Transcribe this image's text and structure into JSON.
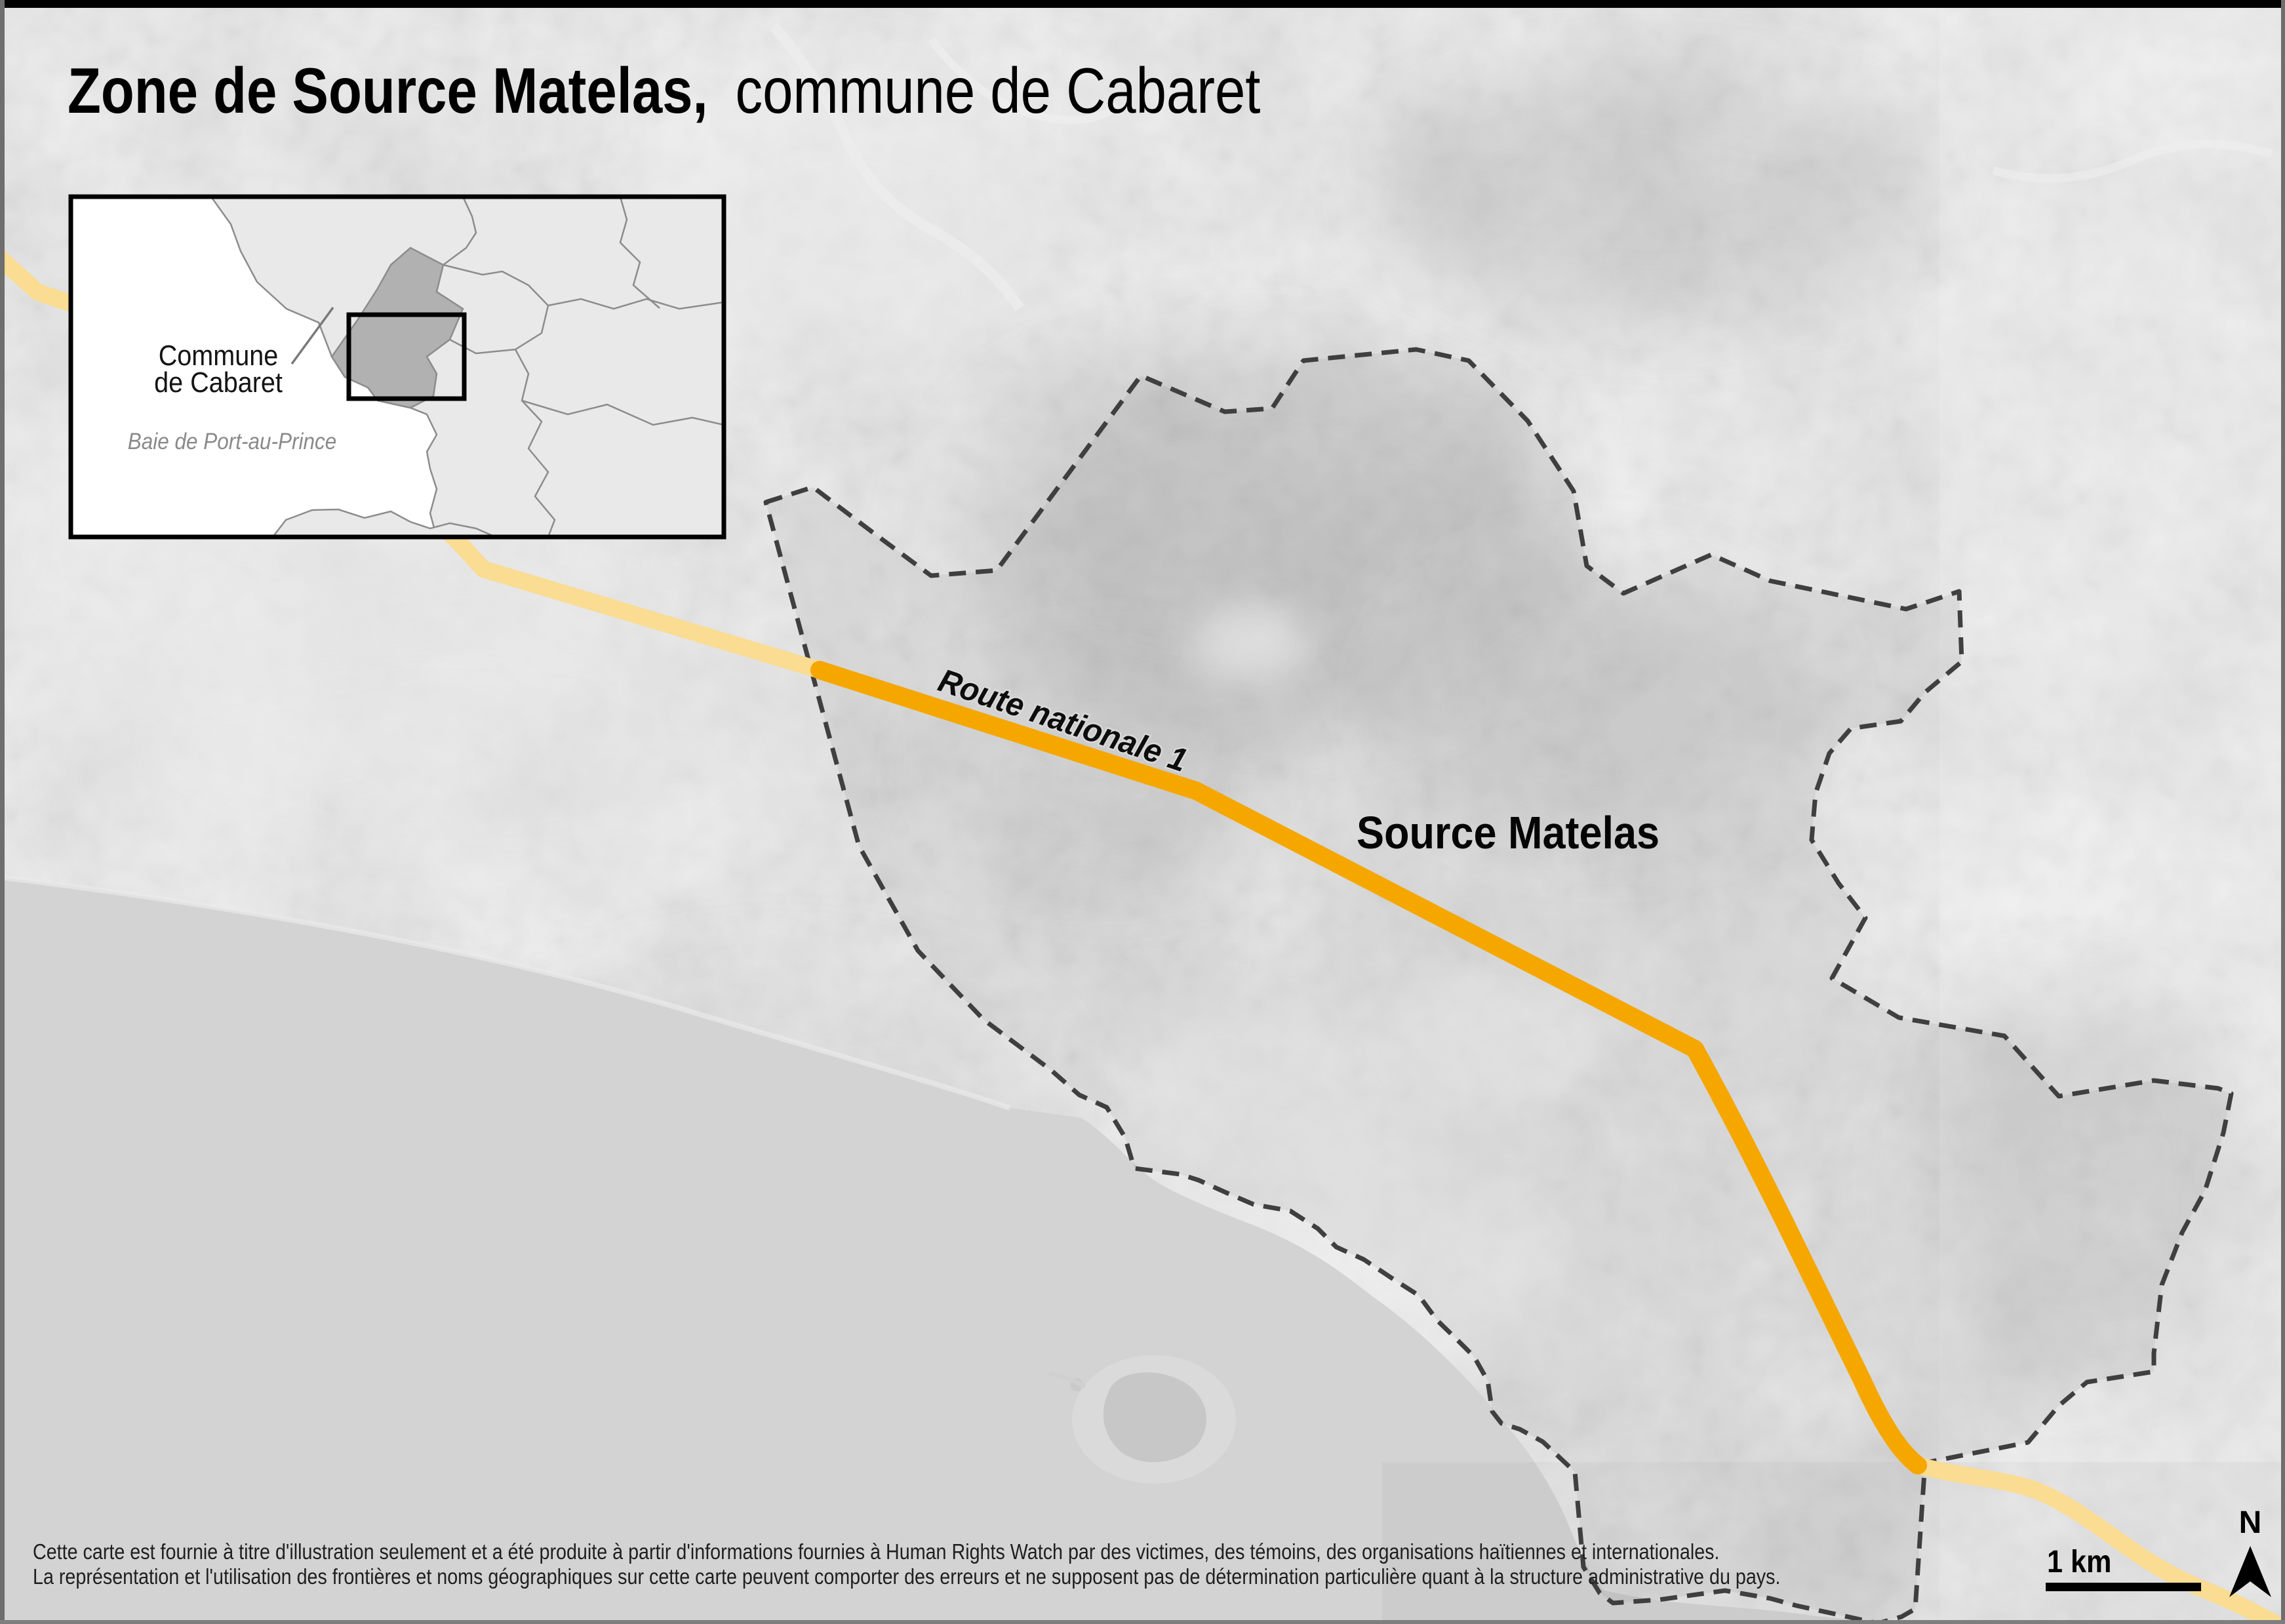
{
  "title": {
    "bold": "Zone de Source Matelas,",
    "regular": "commune de Cabaret"
  },
  "inset": {
    "commune_label_line1": "Commune",
    "commune_label_line2": "de Cabaret",
    "bay_label": "Baie de Port-au-Prince"
  },
  "map": {
    "zone_label": "Source Matelas",
    "road_label": "Route nationale 1"
  },
  "scale": {
    "label": "1 km"
  },
  "compass": {
    "label": "N"
  },
  "disclaimer": {
    "line1": "Cette carte est fournie à titre d'illustration seulement et a été produite à partir d'informations fournies à Human Rights Watch par des victimes, des témoins, des organisations haïtiennes et internationales.",
    "line2": "La représentation et l'utilisation des frontières et noms géographiques sur cette carte peuvent comporter des erreurs et ne supposent pas de détermination particulière quant à la structure administrative du pays."
  },
  "colors": {
    "road_highlight": "#F5A700",
    "road_muted": "#FADC92",
    "boundary": "#3F3F3F",
    "sea": "#D3D3D3",
    "land_base": "#CBCBCB",
    "inset_land": "#E9E9E9",
    "inset_commune_fill": "#B1B1B1",
    "inset_border": "#8C8C8C",
    "ink": "#000000",
    "muted_ink": "#8A8A8A"
  }
}
